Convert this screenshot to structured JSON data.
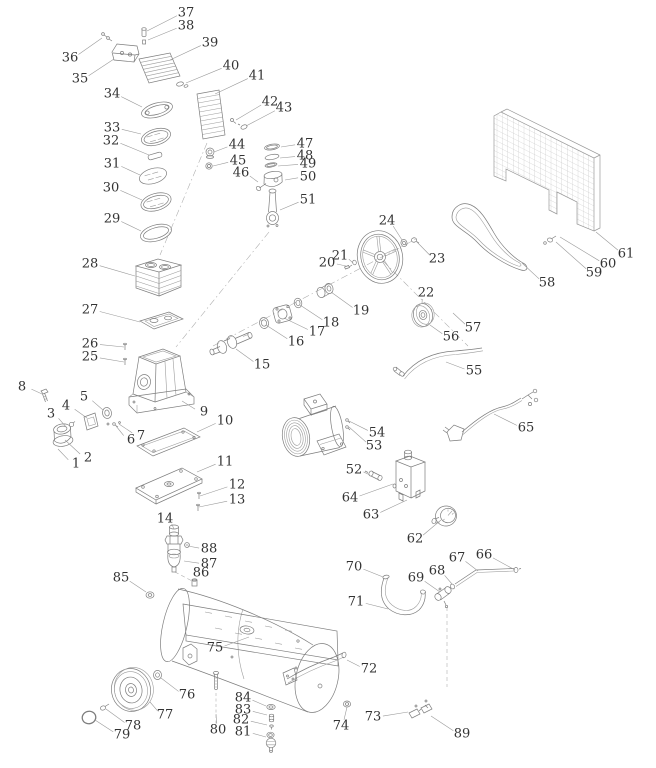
{
  "page": {
    "background": "#ffffff",
    "colors": {
      "part_line": "#7d7d7d",
      "leader_line": "#9a9a9a",
      "label_text": "#333333"
    }
  },
  "diagram": {
    "type": "exploded-parts-diagram",
    "label_font_size": 13,
    "labels": [
      {
        "n": "1",
        "x": 76,
        "y": 464,
        "tx": 58,
        "ty": 449
      },
      {
        "n": "2",
        "x": 88,
        "y": 458,
        "tx": 65,
        "ty": 440
      },
      {
        "n": "3",
        "x": 51,
        "y": 414,
        "tx": 67,
        "ty": 428
      },
      {
        "n": "4",
        "x": 66,
        "y": 406,
        "tx": 87,
        "ty": 418
      },
      {
        "n": "5",
        "x": 84,
        "y": 397,
        "tx": 103,
        "ty": 410
      },
      {
        "n": "6",
        "x": 131,
        "y": 440,
        "tx": 116,
        "ty": 426
      },
      {
        "n": "7",
        "x": 141,
        "y": 436,
        "tx": 119,
        "ty": 424
      },
      {
        "n": "8",
        "x": 22,
        "y": 387,
        "tx": 42,
        "ty": 394
      },
      {
        "n": "9",
        "x": 204,
        "y": 412,
        "tx": 182,
        "ty": 401
      },
      {
        "n": "10",
        "x": 225,
        "y": 421,
        "tx": 197,
        "ty": 432
      },
      {
        "n": "11",
        "x": 225,
        "y": 462,
        "tx": 197,
        "ty": 472
      },
      {
        "n": "12",
        "x": 237,
        "y": 485,
        "tx": 200,
        "ty": 496
      },
      {
        "n": "13",
        "x": 237,
        "y": 500,
        "tx": 199,
        "ty": 507
      },
      {
        "n": "14",
        "x": 165,
        "y": 519,
        "tx": 174,
        "ty": 529
      },
      {
        "n": "15",
        "x": 262,
        "y": 365,
        "tx": 236,
        "ty": 349
      },
      {
        "n": "16",
        "x": 296,
        "y": 342,
        "tx": 266,
        "ty": 325
      },
      {
        "n": "17",
        "x": 317,
        "y": 332,
        "tx": 284,
        "ty": 318
      },
      {
        "n": "18",
        "x": 331,
        "y": 323,
        "tx": 300,
        "ty": 305
      },
      {
        "n": "19",
        "x": 361,
        "y": 311,
        "tx": 331,
        "ty": 292
      },
      {
        "n": "20",
        "x": 327,
        "y": 263,
        "tx": 346,
        "ty": 266
      },
      {
        "n": "21",
        "x": 340,
        "y": 256,
        "tx": 353,
        "ty": 263
      },
      {
        "n": "22",
        "x": 426,
        "y": 293,
        "tx": 422,
        "ty": 303
      },
      {
        "n": "23",
        "x": 437,
        "y": 259,
        "tx": 416,
        "ty": 241
      },
      {
        "n": "24",
        "x": 387,
        "y": 221,
        "tx": 402,
        "ty": 240
      },
      {
        "n": "25",
        "x": 90,
        "y": 357,
        "tx": 124,
        "ty": 362
      },
      {
        "n": "26",
        "x": 90,
        "y": 344,
        "tx": 124,
        "ty": 347
      },
      {
        "n": "27",
        "x": 90,
        "y": 310,
        "tx": 140,
        "ty": 322
      },
      {
        "n": "28",
        "x": 90,
        "y": 264,
        "tx": 135,
        "ty": 276
      },
      {
        "n": "29",
        "x": 112,
        "y": 219,
        "tx": 141,
        "ty": 231
      },
      {
        "n": "30",
        "x": 111,
        "y": 188,
        "tx": 142,
        "ty": 200
      },
      {
        "n": "31",
        "x": 112,
        "y": 164,
        "tx": 140,
        "ty": 175
      },
      {
        "n": "32",
        "x": 111,
        "y": 141,
        "tx": 149,
        "ty": 155
      },
      {
        "n": "33",
        "x": 112,
        "y": 128,
        "tx": 141,
        "ty": 134
      },
      {
        "n": "34",
        "x": 112,
        "y": 94,
        "tx": 142,
        "ty": 107
      },
      {
        "n": "35",
        "x": 80,
        "y": 79,
        "tx": 114,
        "ty": 59
      },
      {
        "n": "36",
        "x": 70,
        "y": 58,
        "tx": 102,
        "ty": 38
      },
      {
        "n": "37",
        "x": 186,
        "y": 13,
        "tx": 147,
        "ty": 31
      },
      {
        "n": "38",
        "x": 186,
        "y": 26,
        "tx": 148,
        "ty": 40
      },
      {
        "n": "39",
        "x": 210,
        "y": 43,
        "tx": 170,
        "ty": 60
      },
      {
        "n": "40",
        "x": 231,
        "y": 66,
        "tx": 186,
        "ty": 83
      },
      {
        "n": "41",
        "x": 257,
        "y": 76,
        "tx": 215,
        "ty": 94
      },
      {
        "n": "42",
        "x": 270,
        "y": 102,
        "tx": 236,
        "ty": 120
      },
      {
        "n": "43",
        "x": 284,
        "y": 108,
        "tx": 246,
        "ty": 126
      },
      {
        "n": "44",
        "x": 237,
        "y": 145,
        "tx": 214,
        "ty": 152
      },
      {
        "n": "45",
        "x": 238,
        "y": 161,
        "tx": 213,
        "ty": 166
      },
      {
        "n": "46",
        "x": 241,
        "y": 173,
        "tx": 258,
        "ty": 182
      },
      {
        "n": "47",
        "x": 305,
        "y": 144,
        "tx": 281,
        "ty": 147
      },
      {
        "n": "48",
        "x": 305,
        "y": 156,
        "tx": 280,
        "ty": 158
      },
      {
        "n": "49",
        "x": 308,
        "y": 164,
        "tx": 278,
        "ty": 166
      },
      {
        "n": "50",
        "x": 308,
        "y": 177,
        "tx": 285,
        "ty": 180
      },
      {
        "n": "51",
        "x": 308,
        "y": 200,
        "tx": 280,
        "ty": 210
      },
      {
        "n": "52",
        "x": 354,
        "y": 470,
        "tx": 370,
        "ty": 475
      },
      {
        "n": "53",
        "x": 374,
        "y": 446,
        "tx": 349,
        "ty": 427
      },
      {
        "n": "54",
        "x": 377,
        "y": 433,
        "tx": 349,
        "ty": 421
      },
      {
        "n": "55",
        "x": 474,
        "y": 371,
        "tx": 446,
        "ty": 362
      },
      {
        "n": "56",
        "x": 451,
        "y": 337,
        "tx": 430,
        "ty": 325
      },
      {
        "n": "57",
        "x": 473,
        "y": 328,
        "tx": 453,
        "ty": 313
      },
      {
        "n": "58",
        "x": 547,
        "y": 283,
        "tx": 522,
        "ty": 263
      },
      {
        "n": "59",
        "x": 594,
        "y": 273,
        "tx": 556,
        "ty": 242
      },
      {
        "n": "60",
        "x": 608,
        "y": 264,
        "tx": 560,
        "ty": 237
      },
      {
        "n": "61",
        "x": 626,
        "y": 254,
        "tx": 596,
        "ty": 232
      },
      {
        "n": "62",
        "x": 415,
        "y": 539,
        "tx": 441,
        "ty": 520
      },
      {
        "n": "63",
        "x": 371,
        "y": 515,
        "tx": 407,
        "ty": 500
      },
      {
        "n": "64",
        "x": 350,
        "y": 498,
        "tx": 393,
        "ty": 484
      },
      {
        "n": "65",
        "x": 526,
        "y": 428,
        "tx": 494,
        "ty": 414
      },
      {
        "n": "66",
        "x": 484,
        "y": 555,
        "tx": 515,
        "ty": 570
      },
      {
        "n": "67",
        "x": 457,
        "y": 558,
        "tx": 478,
        "ty": 571
      },
      {
        "n": "68",
        "x": 437,
        "y": 571,
        "tx": 452,
        "ty": 584
      },
      {
        "n": "69",
        "x": 416,
        "y": 578,
        "tx": 440,
        "ty": 592
      },
      {
        "n": "70",
        "x": 354,
        "y": 567,
        "tx": 383,
        "ty": 577
      },
      {
        "n": "71",
        "x": 356,
        "y": 602,
        "tx": 388,
        "ty": 609
      },
      {
        "n": "72",
        "x": 369,
        "y": 669,
        "tx": 347,
        "ty": 660
      },
      {
        "n": "73",
        "x": 373,
        "y": 717,
        "tx": 408,
        "ty": 712
      },
      {
        "n": "74",
        "x": 341,
        "y": 726,
        "tx": 347,
        "ty": 707
      },
      {
        "n": "75",
        "x": 215,
        "y": 648,
        "tx": 249,
        "ty": 637
      },
      {
        "n": "76",
        "x": 187,
        "y": 695,
        "tx": 161,
        "ty": 678
      },
      {
        "n": "77",
        "x": 165,
        "y": 715,
        "tx": 150,
        "ty": 702
      },
      {
        "n": "78",
        "x": 133,
        "y": 726,
        "tx": 106,
        "ty": 709
      },
      {
        "n": "79",
        "x": 122,
        "y": 735,
        "tx": 95,
        "ty": 720
      },
      {
        "n": "80",
        "x": 218,
        "y": 730,
        "tx": 216,
        "ty": 714
      },
      {
        "n": "81",
        "x": 243,
        "y": 732,
        "tx": 266,
        "ty": 737
      },
      {
        "n": "82",
        "x": 241,
        "y": 720,
        "tx": 267,
        "ty": 725
      },
      {
        "n": "83",
        "x": 243,
        "y": 710,
        "tx": 267,
        "ty": 715
      },
      {
        "n": "84",
        "x": 243,
        "y": 698,
        "tx": 266,
        "ty": 706
      },
      {
        "n": "85",
        "x": 121,
        "y": 578,
        "tx": 146,
        "ty": 592
      },
      {
        "n": "86",
        "x": 201,
        "y": 573,
        "tx": 195,
        "ty": 581
      },
      {
        "n": "87",
        "x": 209,
        "y": 564,
        "tx": 184,
        "ty": 561
      },
      {
        "n": "88",
        "x": 209,
        "y": 549,
        "tx": 188,
        "ty": 546
      },
      {
        "n": "89",
        "x": 462,
        "y": 734,
        "tx": 431,
        "ty": 716
      }
    ]
  }
}
